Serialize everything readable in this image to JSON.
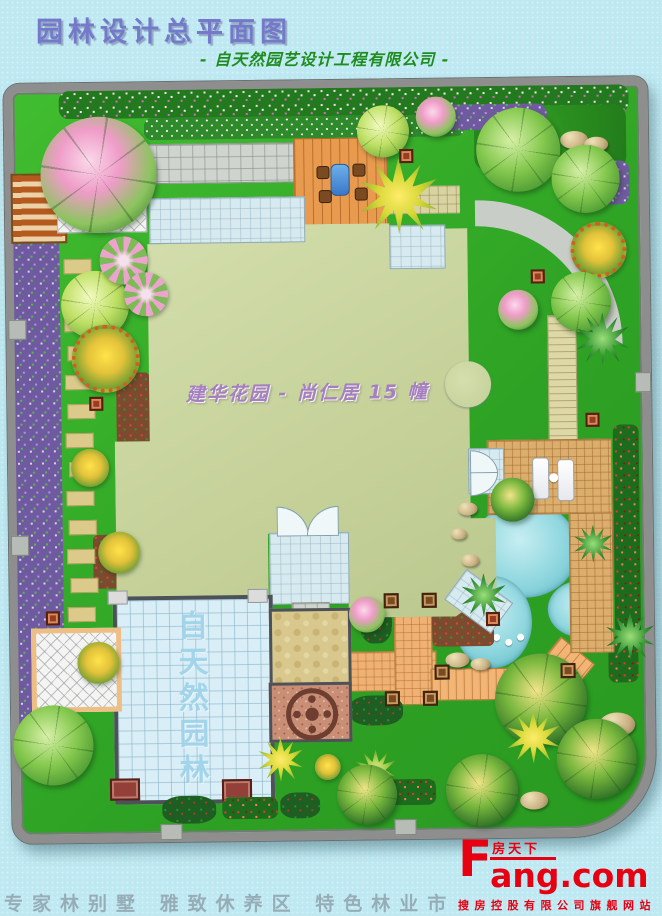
{
  "header": {
    "title": "园林设计总平面图",
    "subtitle": "- 自天然园艺设计工程有限公司 -"
  },
  "plan": {
    "building_label": "建华花园 - 尚仁居 15 幢",
    "plaza_watermark": "自天然园林"
  },
  "footer": {
    "cutoff_text": "专家林别墅 雅致休养区 特色林业市",
    "brand_initial": "F",
    "brand_cn": "房天下",
    "brand_rest": "ang.com",
    "tagline": "搜房控股有限公司旗舰网站"
  },
  "colors": {
    "background_cyan": "#bfe9f2",
    "title_blue": "#7479c9",
    "subtitle_green": "#1f8c1f",
    "label_purple": "#a57fc0",
    "lawn_green": "#38b429",
    "water_cyan": "#8ed6de",
    "building_sage": "#cbd6a2",
    "brand_red": "#e60012"
  }
}
